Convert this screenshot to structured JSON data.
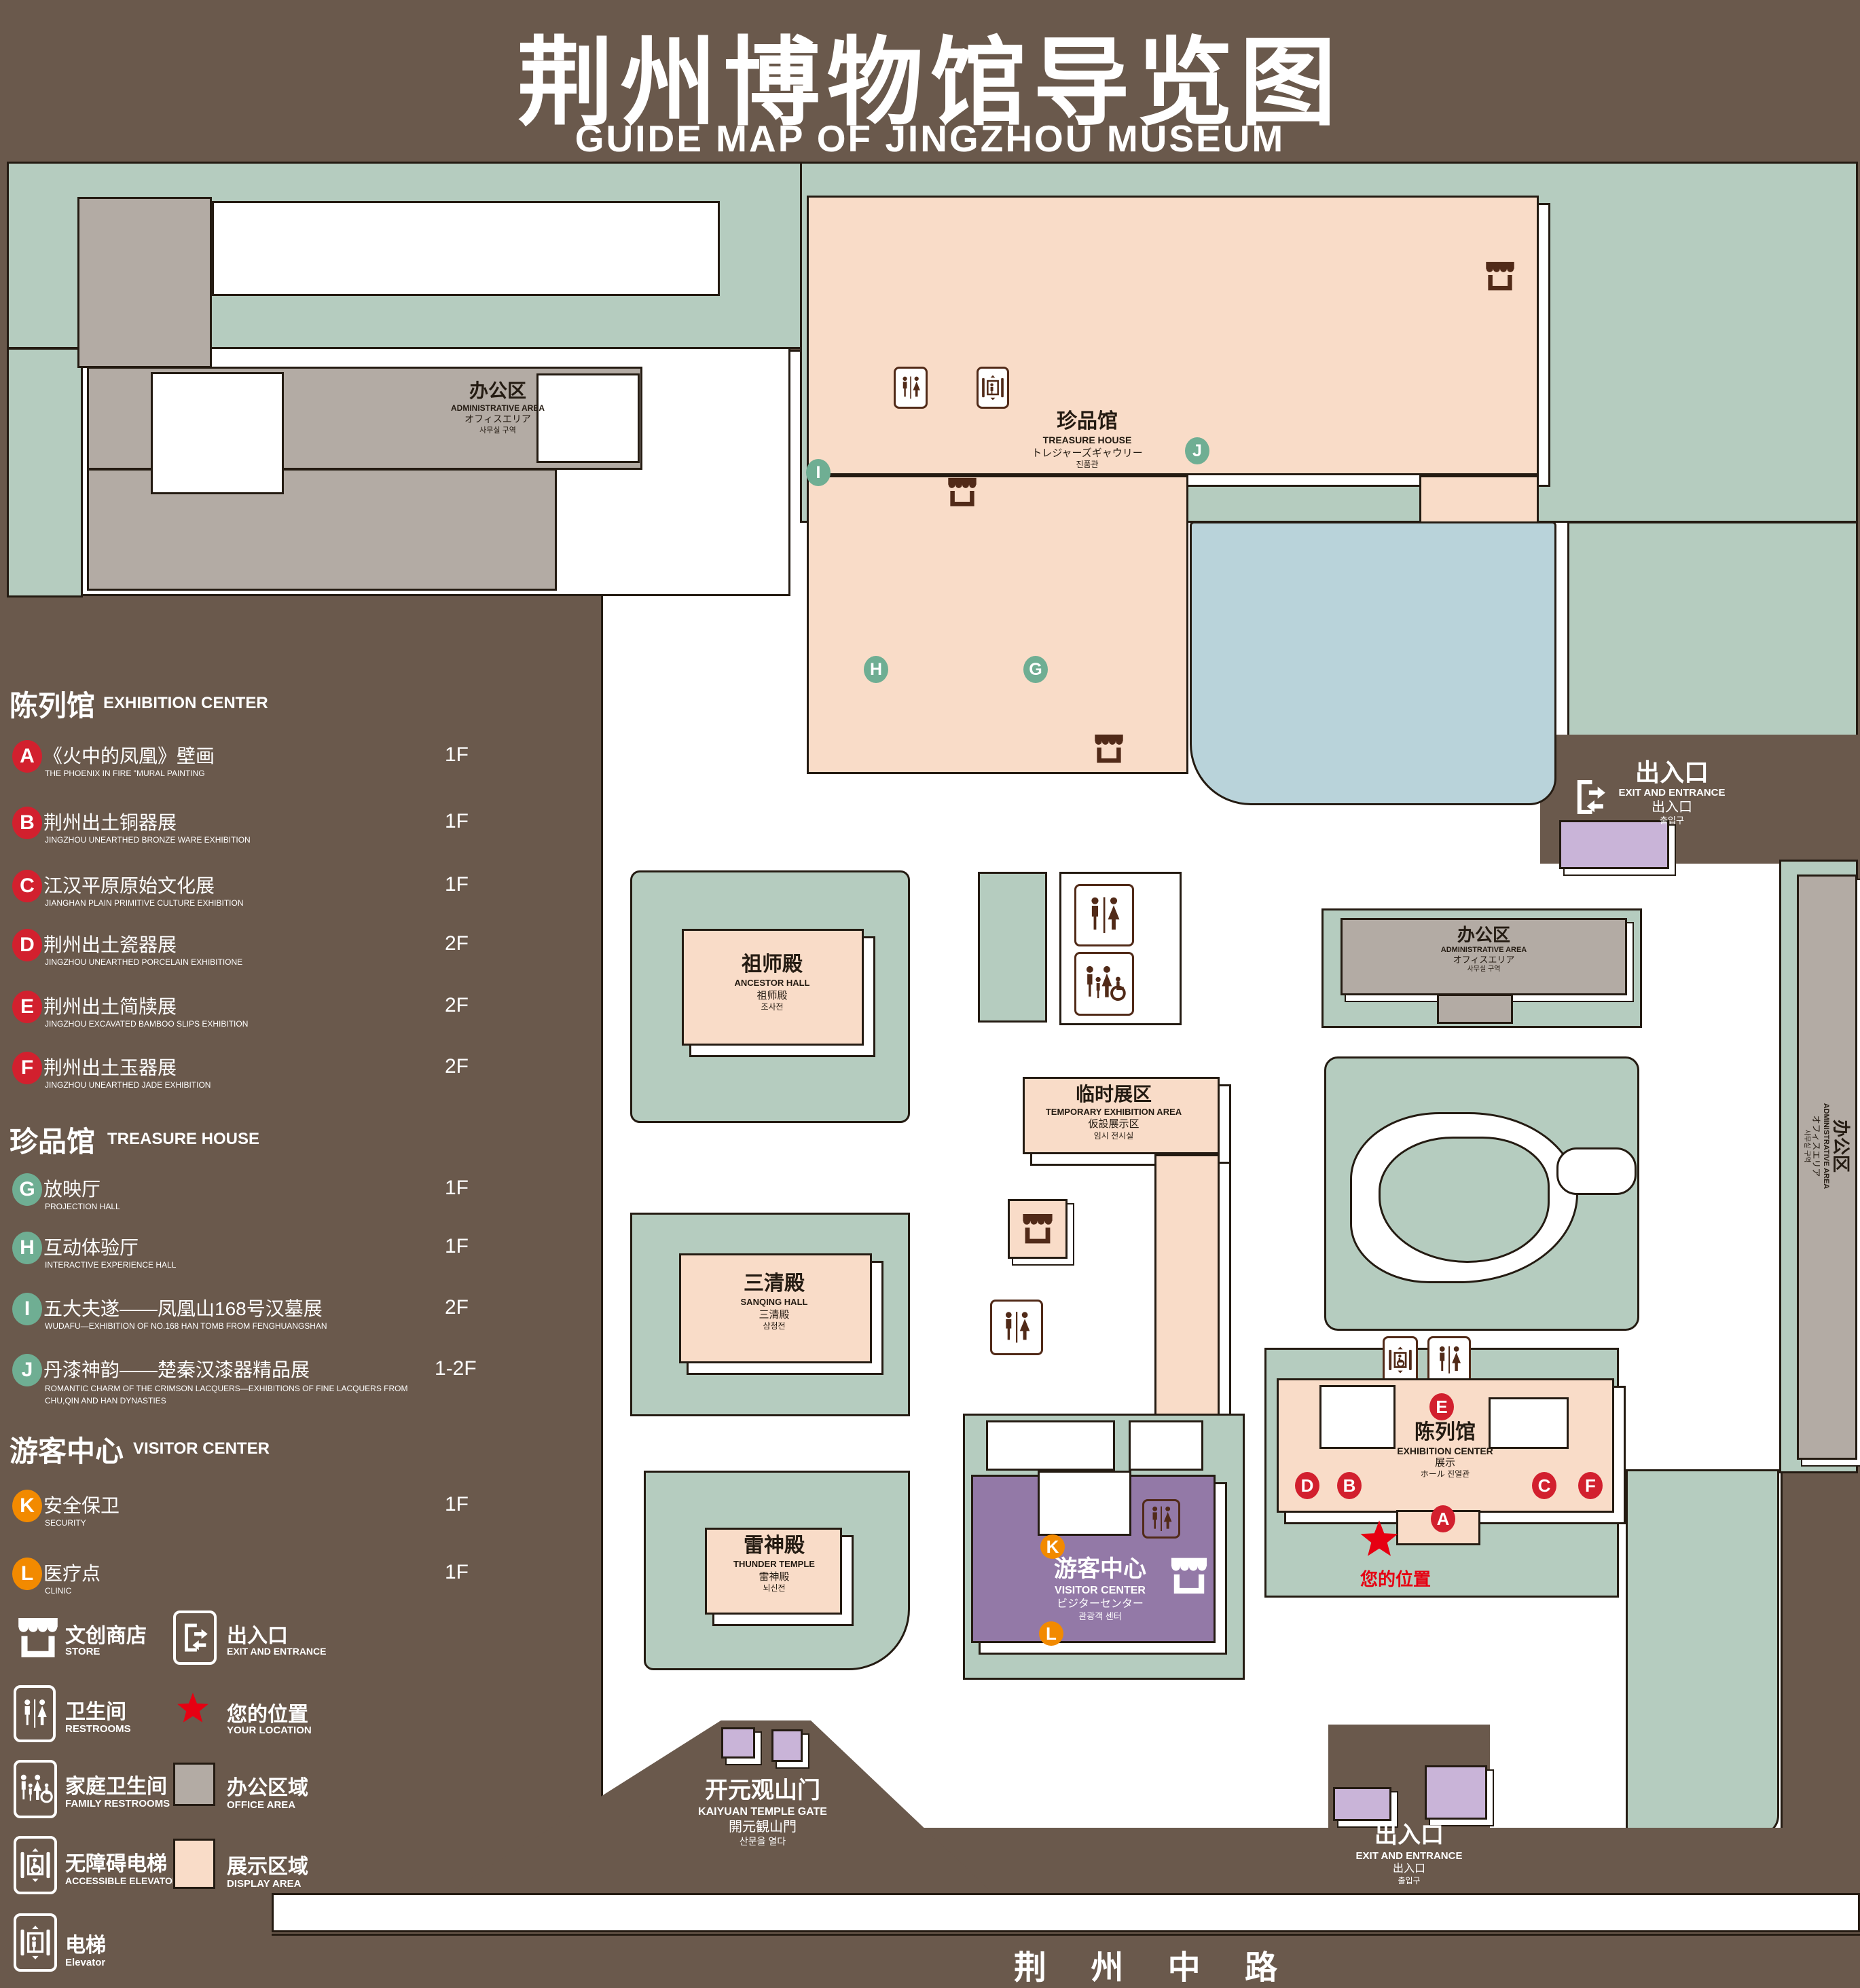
{
  "title": {
    "zh": "荆州博物馆导览图",
    "en": "GUIDE MAP OF JINGZHOU MUSEUM"
  },
  "legend": {
    "sections": [
      {
        "zh": "陈列馆",
        "en": "EXHIBITION CENTER",
        "items": [
          {
            "letter": "A",
            "zh": "《火中的凤凰》壁画",
            "en": "THE PHOENIX IN FIRE \"MURAL PAINTING",
            "floor": "1F"
          },
          {
            "letter": "B",
            "zh": "荆州出土铜器展",
            "en": "JINGZHOU UNEARTHED BRONZE WARE EXHIBITION",
            "floor": "1F"
          },
          {
            "letter": "C",
            "zh": "江汉平原原始文化展",
            "en": "JIANGHAN PLAIN PRIMITIVE CULTURE EXHIBITION",
            "floor": "1F"
          },
          {
            "letter": "D",
            "zh": "荆州出土瓷器展",
            "en": "JINGZHOU UNEARTHED PORCELAIN EXHIBITIONE",
            "floor": "2F"
          },
          {
            "letter": "E",
            "zh": "荆州出土简牍展",
            "en": "JINGZHOU EXCAVATED BAMBOO SLIPS EXHIBITION",
            "floor": "2F"
          },
          {
            "letter": "F",
            "zh": "荆州出土玉器展",
            "en": "JINGZHOU UNEARTHED JADE EXHIBITION",
            "floor": "2F"
          }
        ]
      },
      {
        "zh": "珍品馆",
        "en": "TREASURE HOUSE",
        "items": [
          {
            "letter": "G",
            "zh": "放映厅",
            "en": "PROJECTION HALL",
            "floor": "1F"
          },
          {
            "letter": "H",
            "zh": "互动体验厅",
            "en": "INTERACTIVE EXPERIENCE HALL",
            "floor": "1F"
          },
          {
            "letter": "I",
            "zh": "五大夫遂——凤凰山168号汉墓展",
            "en": "WUDAFU—EXHIBITION OF NO.168 HAN TOMB FROM FENGHUANGSHAN",
            "floor": "2F"
          },
          {
            "letter": "J",
            "zh": "丹漆神韵——楚秦汉漆器精品展",
            "en": "ROMANTIC CHARM OF THE CRIMSON LACQUERS—EXHIBITIONS OF FINE LACQUERS FROM CHU,QIN AND HAN DYNASTIES",
            "floor": "1-2F"
          }
        ]
      },
      {
        "zh": "游客中心",
        "en": "VISITOR CENTER",
        "items": [
          {
            "letter": "K",
            "zh": "安全保卫",
            "en": "SECURITY",
            "floor": "1F"
          },
          {
            "letter": "L",
            "zh": "医疗点",
            "en": "CLINIC",
            "floor": "1F"
          }
        ]
      }
    ],
    "icons": [
      {
        "zh": "文创商店",
        "en": "STORE",
        "icon": "store-icon"
      },
      {
        "zh": "出入口",
        "en": "EXIT AND ENTRANCE",
        "icon": "exit-icon"
      },
      {
        "zh": "卫生间",
        "en": "RESTROOMS",
        "icon": "restroom-icon"
      },
      {
        "zh": "您的位置",
        "en": "YOUR LOCATION",
        "icon": "location-star-icon"
      },
      {
        "zh": "家庭卫生间",
        "en": "FAMILY RESTROOMS",
        "icon": "family-restroom-icon"
      },
      {
        "zh": "办公区域",
        "en": "OFFICE AREA",
        "icon": "office-area-swatch"
      },
      {
        "zh": "无障碍电梯",
        "en": "ACCESSIBLE ELEVATOR",
        "icon": "accessible-elevator-icon"
      },
      {
        "zh": "展示区域",
        "en": "DISPLAY AREA",
        "icon": "display-area-swatch"
      },
      {
        "zh": "电梯",
        "en": "Elevator",
        "icon": "elevator-icon"
      }
    ]
  },
  "map": {
    "buildings": {
      "admin_top": {
        "lines": [
          "办公区",
          "ADMINISTRATIVE AREA",
          "オフィスエリア",
          "사무실 구역"
        ]
      },
      "treasure": {
        "lines": [
          "珍品馆",
          "TREASURE HOUSE",
          "トレジャーズギャウリー",
          "진품관"
        ]
      },
      "ancestor": {
        "lines": [
          "祖师殿",
          "ANCESTOR HALL",
          "祖师殿",
          "조사전"
        ]
      },
      "sanqing": {
        "lines": [
          "三清殿",
          "SANQING HALL",
          "三清殿",
          "삼청전"
        ]
      },
      "thunder": {
        "lines": [
          "雷神殿",
          "THUNDER TEMPLE",
          "雷神殿",
          "뇌신전"
        ]
      },
      "temporary": {
        "lines": [
          "临时展区",
          "TEMPORARY EXHIBITION AREA",
          "仮設展示区",
          "임시 전시실"
        ]
      },
      "admin_right": {
        "lines": [
          "办公区",
          "ADMINISTRATIVE AREA",
          "オフィスエリア",
          "사무실 구역"
        ]
      },
      "admin_side": {
        "lines": [
          "办公区",
          "ADMINISTRATIVE AREA",
          "オフィスエリア",
          "사무실 구역"
        ]
      },
      "exhibition": {
        "lines": [
          "陈列馆",
          "EXHIBITION CENTER",
          "展示",
          "ホール 진열관"
        ]
      },
      "visitor": {
        "lines": [
          "游客中心",
          "VISITOR CENTER",
          "ビジターセンター",
          "관광객 센터"
        ]
      },
      "gate": {
        "lines": [
          "开元观山门",
          "KAIYUAN TEMPLE GATE",
          "開元観山門",
          "산문을 열다"
        ]
      },
      "exit_top": {
        "lines": [
          "出入口",
          "EXIT AND ENTRANCE",
          "出入口",
          "출입구"
        ]
      },
      "exit_bottom": {
        "lines": [
          "出入口",
          "EXIT AND ENTRANCE",
          "出入口",
          "출입구"
        ]
      }
    },
    "road": "荆 州 中 路",
    "your_location": "您的位置",
    "markers": {
      "A": "A",
      "B": "B",
      "C": "C",
      "D": "D",
      "E": "E",
      "F": "F",
      "G": "G",
      "H": "H",
      "I": "I",
      "J": "J",
      "K": "K",
      "L": "L"
    }
  },
  "colors": {
    "background": "#6a594c",
    "landscape_green": "#b5ccbf",
    "display_area": "#f9dcc8",
    "office_area": "#b3aba4",
    "visitor_center": "#9379a7",
    "gate_building": "#c9b4d8",
    "pond": "#b9d3da",
    "marker_red": "#d2202e",
    "marker_green": "#6fae93",
    "marker_orange": "#f28a00",
    "location_red": "#e60012",
    "icon_brown": "#512a18"
  }
}
